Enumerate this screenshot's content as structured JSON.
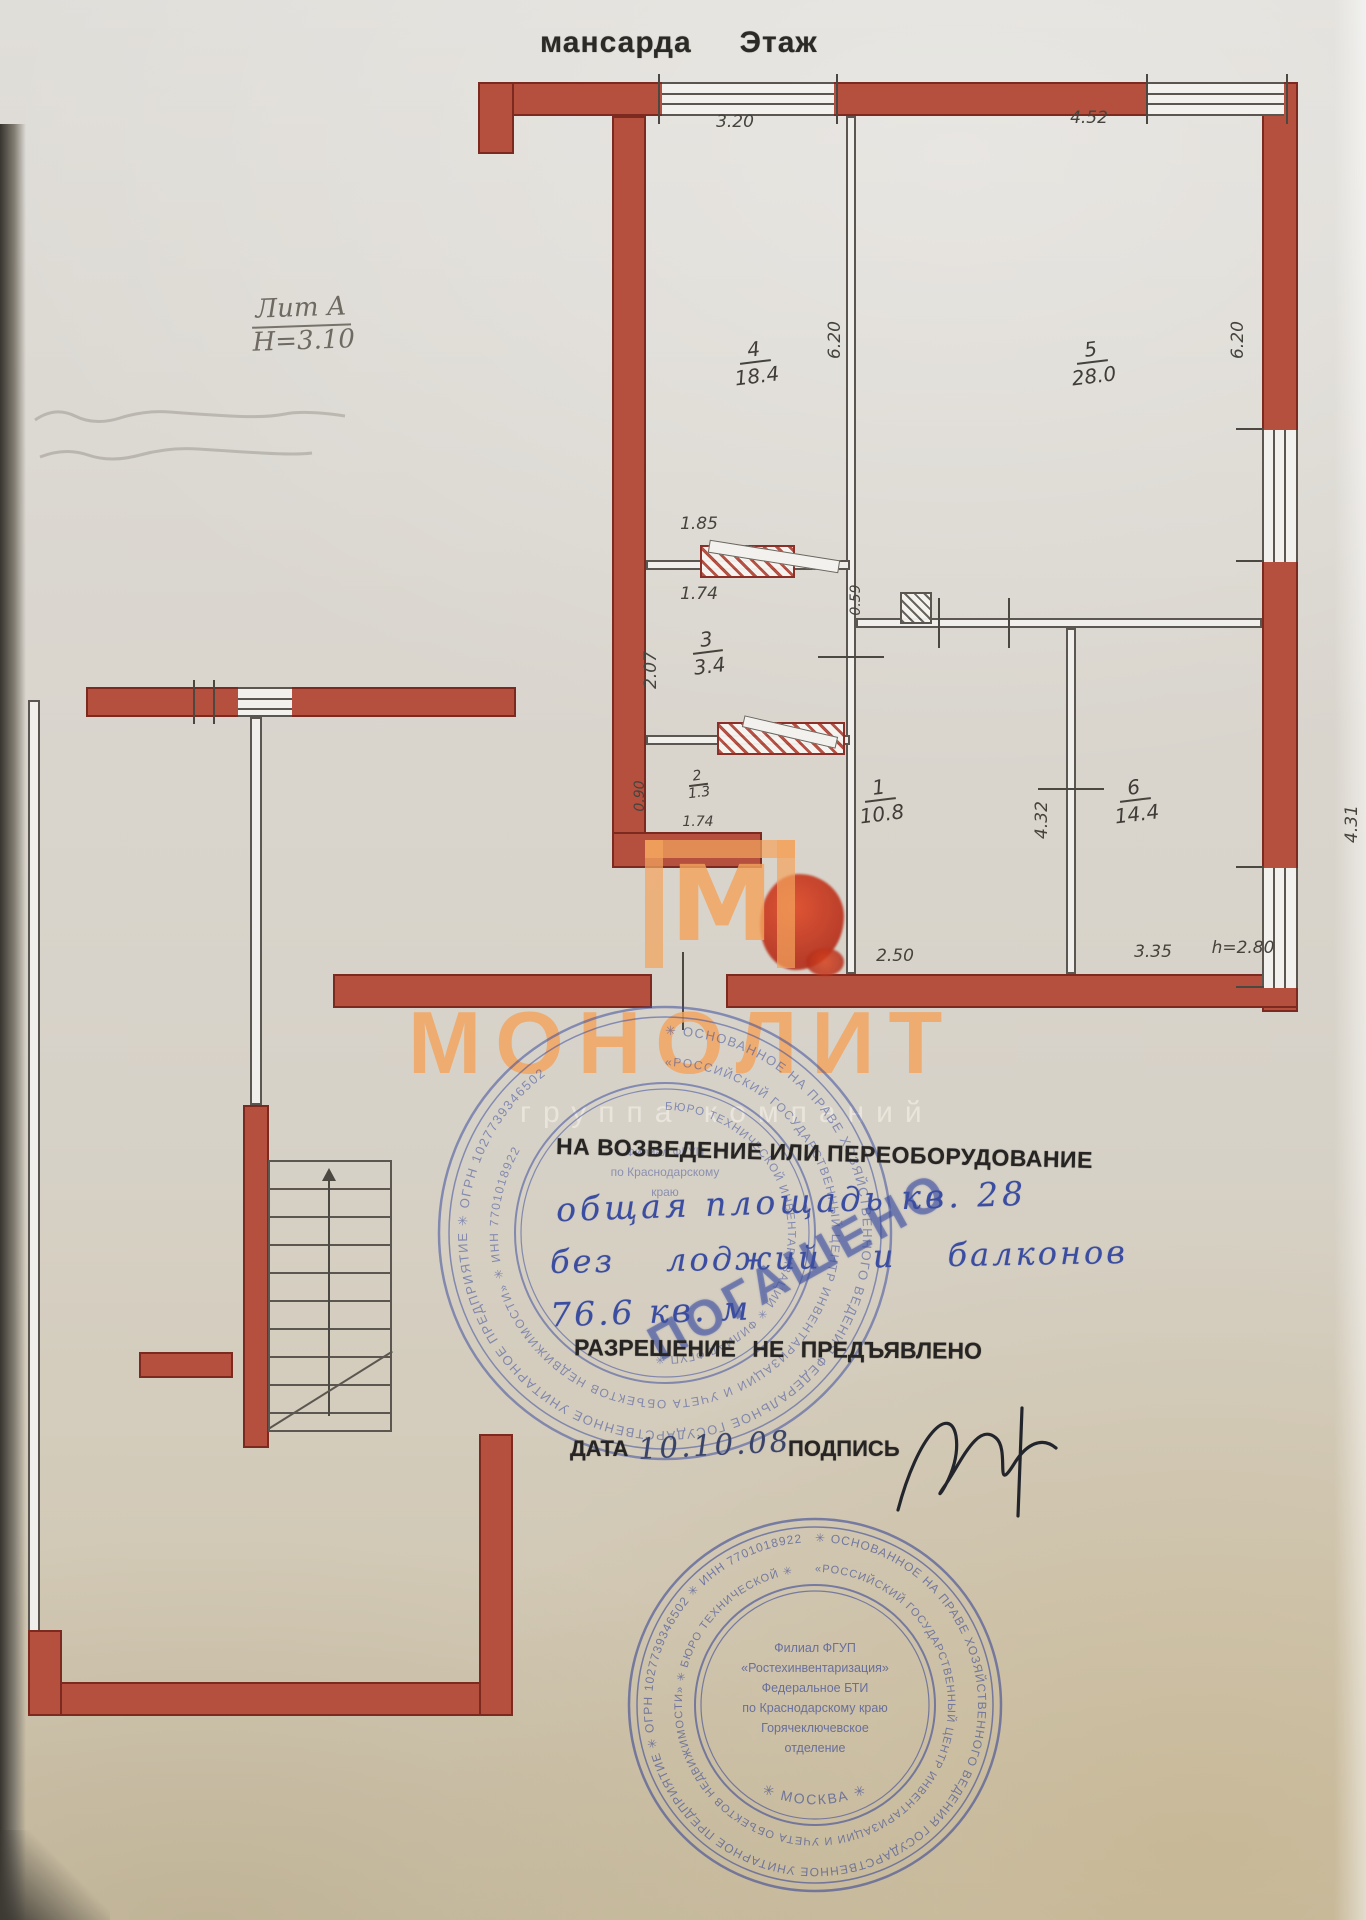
{
  "page": {
    "title_left": "мансарда",
    "title_right": "Этаж"
  },
  "plan": {
    "lit": "Лит А",
    "height": "Н=3.10",
    "rooms": {
      "r1": {
        "num": "1",
        "area": "10.8"
      },
      "r2": {
        "num": "2",
        "area": "1.3"
      },
      "r3": {
        "num": "3",
        "area": "3.4"
      },
      "r4": {
        "num": "4",
        "area": "18.4"
      },
      "r5": {
        "num": "5",
        "area": "28.0"
      },
      "r6": {
        "num": "6",
        "area": "14.4"
      }
    },
    "dims": {
      "room4_top": "3.20",
      "room5_top": "4.52",
      "room4_side": "6.20",
      "room5_side": "6.20",
      "closet_top": "1.85",
      "room3_top": "1.74",
      "niche_side": "0.59",
      "room3_side": "2.07",
      "room2_side": "0.90",
      "room2_bottom": "1.74",
      "room6_left": "4.32",
      "room6_right": "4.31",
      "hall_bottom": "2.50",
      "room6_bottom": "3.35",
      "ceiling_height": "h=2.80"
    }
  },
  "watermark": {
    "logo_letter": "М",
    "brand": "МОНОЛИТ",
    "subtitle": "группа компаний"
  },
  "overprint": {
    "line1": "НА ВОЗВЕДЕНИЕ ИЛИ ПЕРЕОБОРУДОВАНИЕ",
    "line2": "общая площадь кв. 28",
    "line3": "без лоджий и балконов",
    "line4": "76.6 кв. м",
    "line5": "РАЗРЕШЕНИЕ НЕ ПРЕДЪЯВЛЕНО",
    "cancelled": "ПОГАШЕНО",
    "date_label": "ДАТА",
    "date_value": "10.10.08",
    "sign_label": "ПОДПИСЬ"
  },
  "stamps": {
    "upper": {
      "ring_outer": "✳ ОСНОВАННОЕ НА ПРАВЕ ХОЗЯЙСТВЕННОГО ВЕДЕНИЯ ФЕДЕРАЛЬНОЕ ГОСУДАРСТВЕННОЕ УНИТАРНОЕ ПРЕДПРИЯТИЕ ✳ ОГРН 1027739346502",
      "ring_mid": "«РОССИЙСКИЙ ГОСУДАРСТВЕННЫЙ ЦЕНТР ИНВЕНТАРИЗАЦИИ И УЧЕТА ОБЪЕКТОВ НЕДВИЖИМОСТИ» ✳ ИНН 7701018922",
      "ring_inner": "БЮРО ТЕХНИЧЕСКОЙ ИНВЕНТАРИЗАЦИИ ✳ ФИЛИАЛ ФГУП ✳",
      "center": [
        "Филиал ФГУП",
        "по Краснодарскому",
        "краю"
      ]
    },
    "lower": {
      "ring_outer": "✳ ОСНОВАННОЕ НА ПРАВЕ ХОЗЯЙСТВЕННОГО ВЕДЕНИЯ ГОСУДАРСТВЕННОЕ УНИТАРНОЕ ПРЕДПРИЯТИЕ ✳ ОГРН 1027739346502 ✳ ИНН 7701018922",
      "ring_mid": "«РОССИЙСКИЙ ГОСУДАРСТВЕННЫЙ ЦЕНТР ИНВЕНТАРИЗАЦИИ И УЧЕТА ОБЪЕКТОВ НЕДВИЖИМОСТИ» ✳ БЮРО ТЕХНИЧЕСКОЙ ✳",
      "bottom_arc": "✳ МОСКВА ✳",
      "center": [
        "Филиал ФГУП",
        "«Ростехинвентаризация»",
        "Федеральное БТИ",
        "по Краснодарскому краю",
        "Горячеключевское",
        "отделение"
      ]
    }
  }
}
